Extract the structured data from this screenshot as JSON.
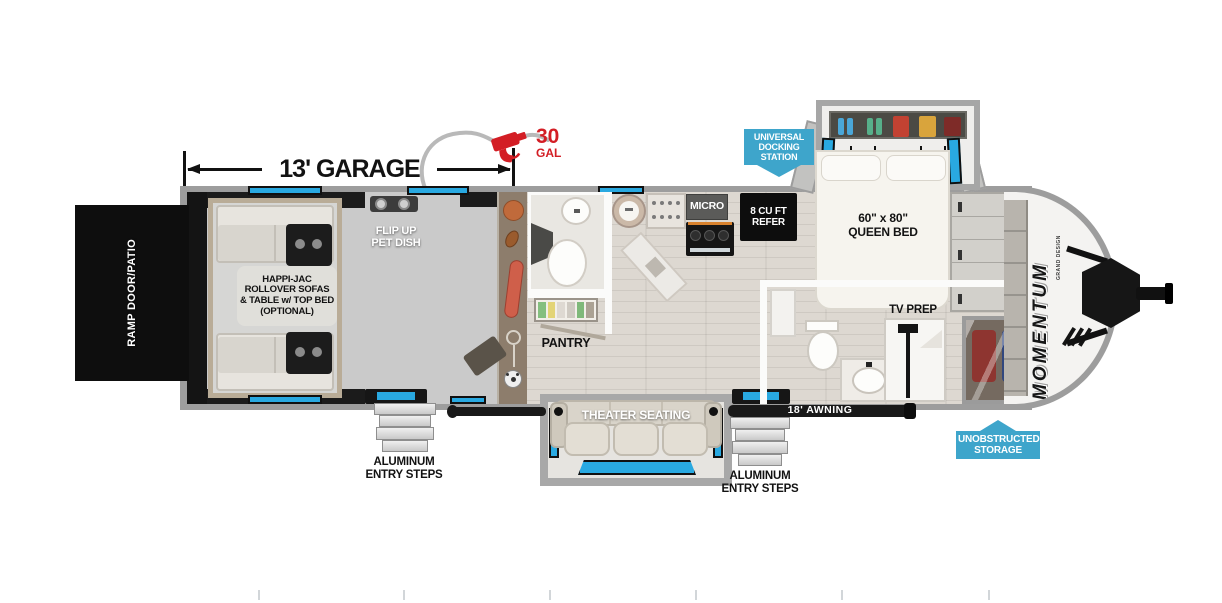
{
  "colors": {
    "callout_blue": "#3EA5CB",
    "window_blue": "#29A9E1",
    "accent_red": "#D31E25",
    "wall_gray": "#9D9D9D",
    "garage_floor": "#CACACA",
    "storage_brown": "#8D7D6C",
    "sofa_beige": "#D9D4CA"
  },
  "brand": {
    "name": "MOMENTUM",
    "maker": "GRAND DESIGN"
  },
  "dimensions": {
    "garage": "13' GARAGE",
    "fuel_value": "30",
    "fuel_unit": "GAL",
    "awning": "18' AWNING"
  },
  "callouts": {
    "docking": [
      "UNIVERSAL",
      "DOCKING",
      "STATION"
    ],
    "storage": [
      "UNOBSTRUCTED",
      "STORAGE"
    ]
  },
  "labels": {
    "ramp_door": "RAMP DOOR/PATIO",
    "happijac": [
      "HAPPI-JAC",
      "ROLLOVER SOFAS",
      "& TABLE w/ TOP BED",
      "(OPTIONAL)"
    ],
    "pet_dish": [
      "FLIP UP",
      "PET DISH"
    ],
    "pantry": "PANTRY",
    "micro": "MICRO",
    "refer": [
      "8 CU FT",
      "REFER"
    ],
    "queen_bed": [
      "60\" x 80\"",
      "QUEEN BED"
    ],
    "tv_prep": "TV PREP",
    "theater_seating": "THEATER SEATING",
    "steps_left": [
      "ALUMINUM",
      "ENTRY STEPS"
    ],
    "steps_right": [
      "ALUMINUM",
      "ENTRY STEPS"
    ]
  }
}
